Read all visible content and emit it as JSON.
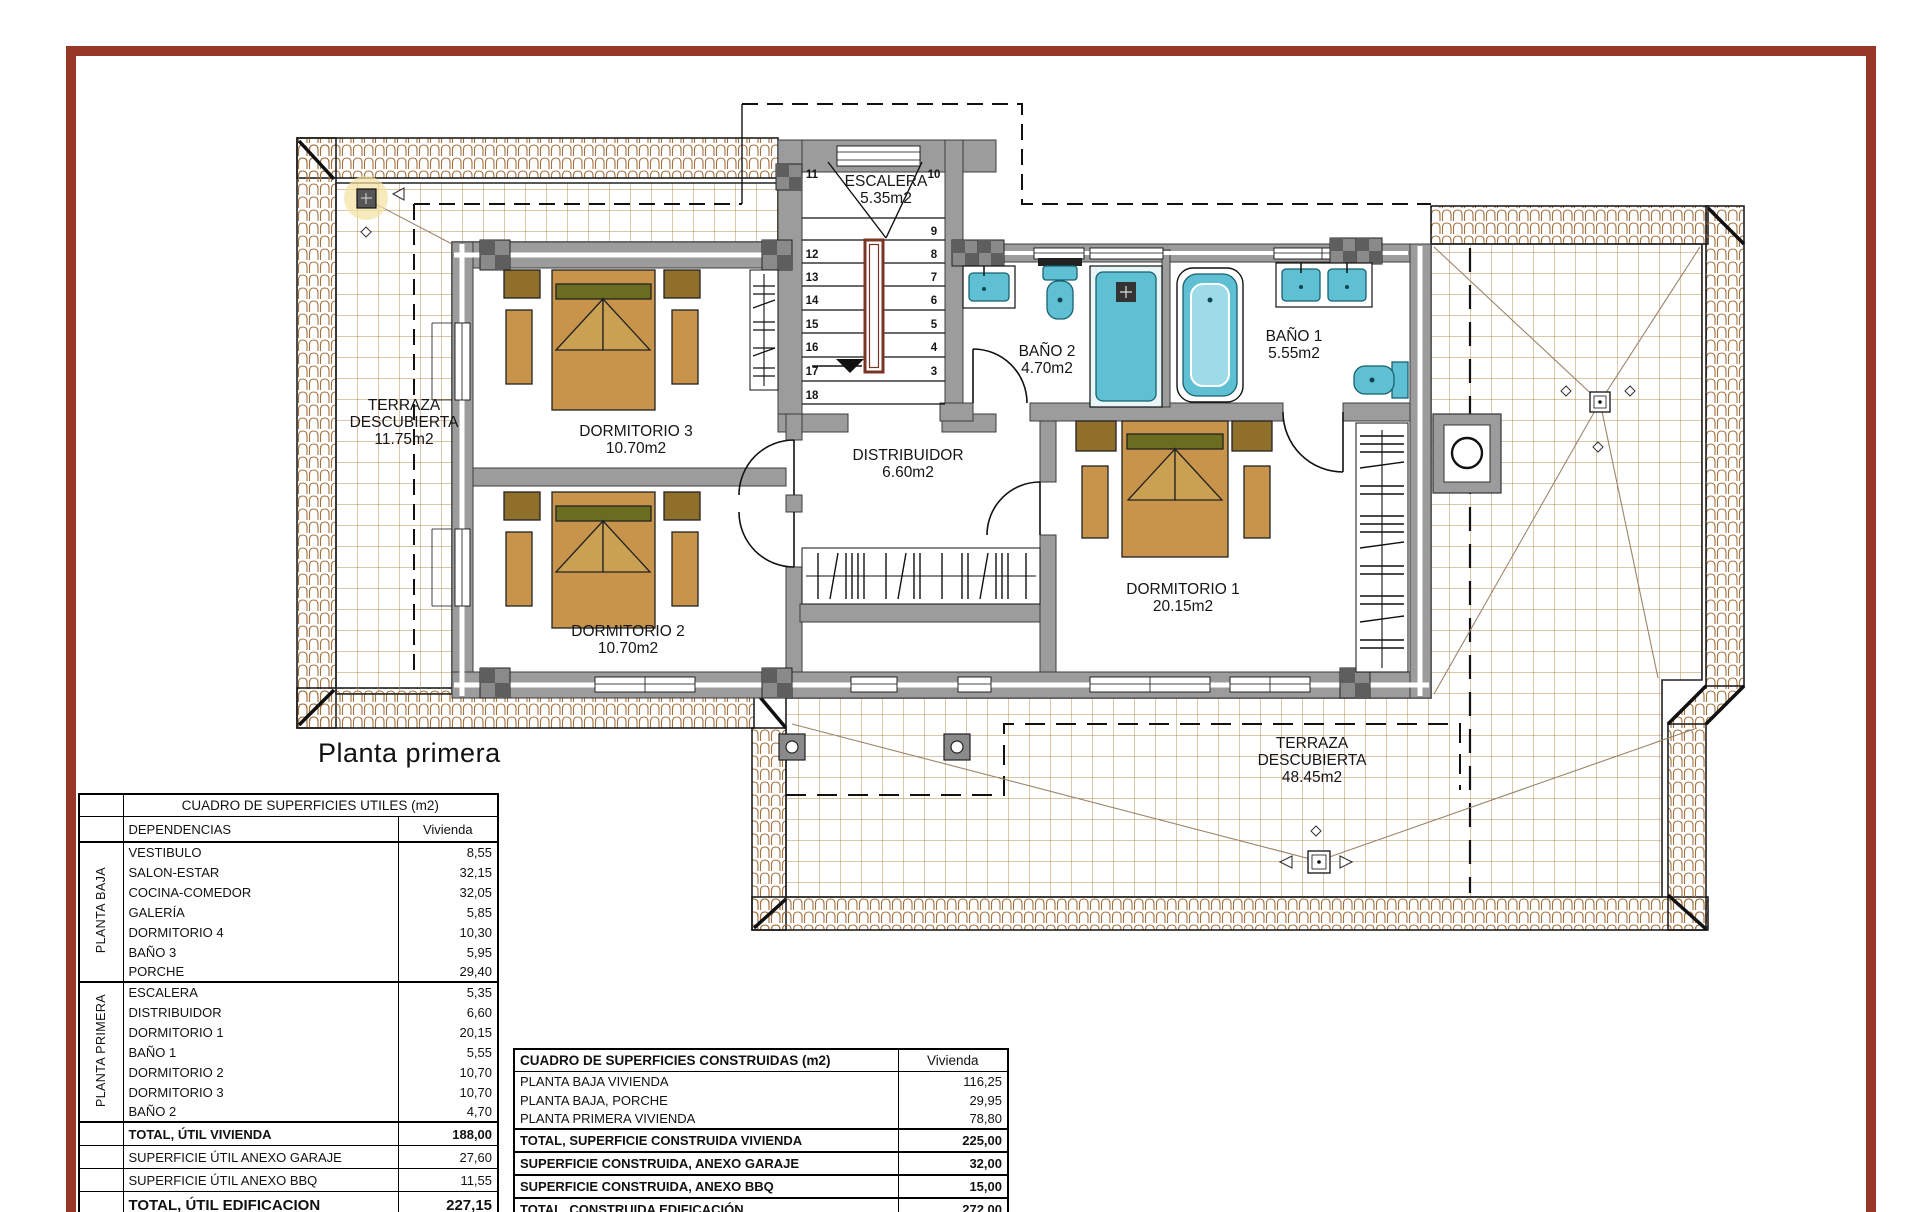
{
  "page": {
    "title": "Planta primera"
  },
  "plan": {
    "labels": {
      "terraza_left": {
        "l1": "TERRAZA",
        "l2": "DESCUBIERTA",
        "l3": "11.75m2"
      },
      "terraza_bottom": {
        "l1": "TERRAZA",
        "l2": "DESCUBIERTA",
        "l3": "48.45m2"
      },
      "escalera": {
        "name": "ESCALERA",
        "area": "5.35m2"
      },
      "dormitorio3": {
        "name": "DORMITORIO 3",
        "area": "10.70m2"
      },
      "dormitorio2": {
        "name": "DORMITORIO 2",
        "area": "10.70m2"
      },
      "dormitorio1": {
        "name": "DORMITORIO 1",
        "area": "20.15m2"
      },
      "distribuidor": {
        "name": "DISTRIBUIDOR",
        "area": "6.60m2"
      },
      "bano1": {
        "name": "BAÑO 1",
        "area": "5.55m2"
      },
      "bano2": {
        "name": "BAÑO 2",
        "area": "4.70m2"
      }
    },
    "stair_numbers": {
      "left": [
        "11",
        "12",
        "13",
        "14",
        "15",
        "16",
        "17",
        "18"
      ],
      "right": [
        "10",
        "9",
        "8",
        "7",
        "6",
        "5",
        "4",
        "3"
      ]
    }
  },
  "tables": {
    "left": {
      "title": "CUADRO DE SUPERFICIES UTILES (m2)",
      "col_name": "DEPENDENCIAS",
      "col_value": "Vivienda",
      "groups": [
        {
          "label": "PLANTA BAJA",
          "rows": [
            [
              "VESTIBULO",
              "8,55"
            ],
            [
              "SALON-ESTAR",
              "32,15"
            ],
            [
              "COCINA-COMEDOR",
              "32,05"
            ],
            [
              "GALERÍA",
              "5,85"
            ],
            [
              "DORMITORIO 4",
              "10,30"
            ],
            [
              "BAÑO 3",
              "5,95"
            ],
            [
              "PORCHE",
              "29,40"
            ]
          ]
        },
        {
          "label": "PLANTA PRIMERA",
          "rows": [
            [
              "ESCALERA",
              "5,35"
            ],
            [
              "DISTRIBUIDOR",
              "6,60"
            ],
            [
              "DORMITORIO 1",
              "20,15"
            ],
            [
              "BAÑO 1",
              "5,55"
            ],
            [
              "DORMITORIO 2",
              "10,70"
            ],
            [
              "DORMITORIO 3",
              "10,70"
            ],
            [
              "BAÑO 2",
              "4,70"
            ]
          ]
        }
      ],
      "summary": [
        {
          "label": "TOTAL, ÚTIL VIVIENDA",
          "value": "188,00",
          "style": "bold"
        },
        {
          "label": "SUPERFICIE ÚTIL ANEXO GARAJE",
          "value": "27,60",
          "style": "plain"
        },
        {
          "label": "SUPERFICIE ÚTIL ANEXO BBQ",
          "value": "11,55",
          "style": "plain"
        },
        {
          "label": "TOTAL, ÚTIL EDIFICACION",
          "value": "227,15",
          "style": "bold-large"
        }
      ]
    },
    "right": {
      "title": "CUADRO DE SUPERFICIES CONSTRUIDAS (m2)",
      "col_value": "Vivienda",
      "rows": [
        {
          "label": "PLANTA BAJA VIVIENDA",
          "value": "116,25",
          "style": "plain"
        },
        {
          "label": "PLANTA BAJA, PORCHE",
          "value": "29,95",
          "style": "plain"
        },
        {
          "label": "PLANTA PRIMERA VIVIENDA",
          "value": "78,80",
          "style": "plain"
        },
        {
          "label": "TOTAL, SUPERFICIE CONSTRUIDA VIVIENDA",
          "value": "225,00",
          "style": "bold"
        },
        {
          "label": "SUPERFICIE CONSTRUIDA, ANEXO GARAJE",
          "value": "32,00",
          "style": "bold"
        },
        {
          "label": "SUPERFICIE CONSTRUIDA, ANEXO BBQ",
          "value": "15,00",
          "style": "bold"
        },
        {
          "label": "TOTAL, CONSTRUIDA EDIFICACIÓN",
          "value": "272,00",
          "style": "bold"
        }
      ]
    }
  },
  "colors": {
    "frame": "#963728",
    "wall": "#9c9c9c",
    "tile_line": "#a4703c",
    "grid_line": "#b98c55",
    "fixture": "#5fc0d4",
    "wood": "#c8944b",
    "rail": "#7a3423"
  }
}
